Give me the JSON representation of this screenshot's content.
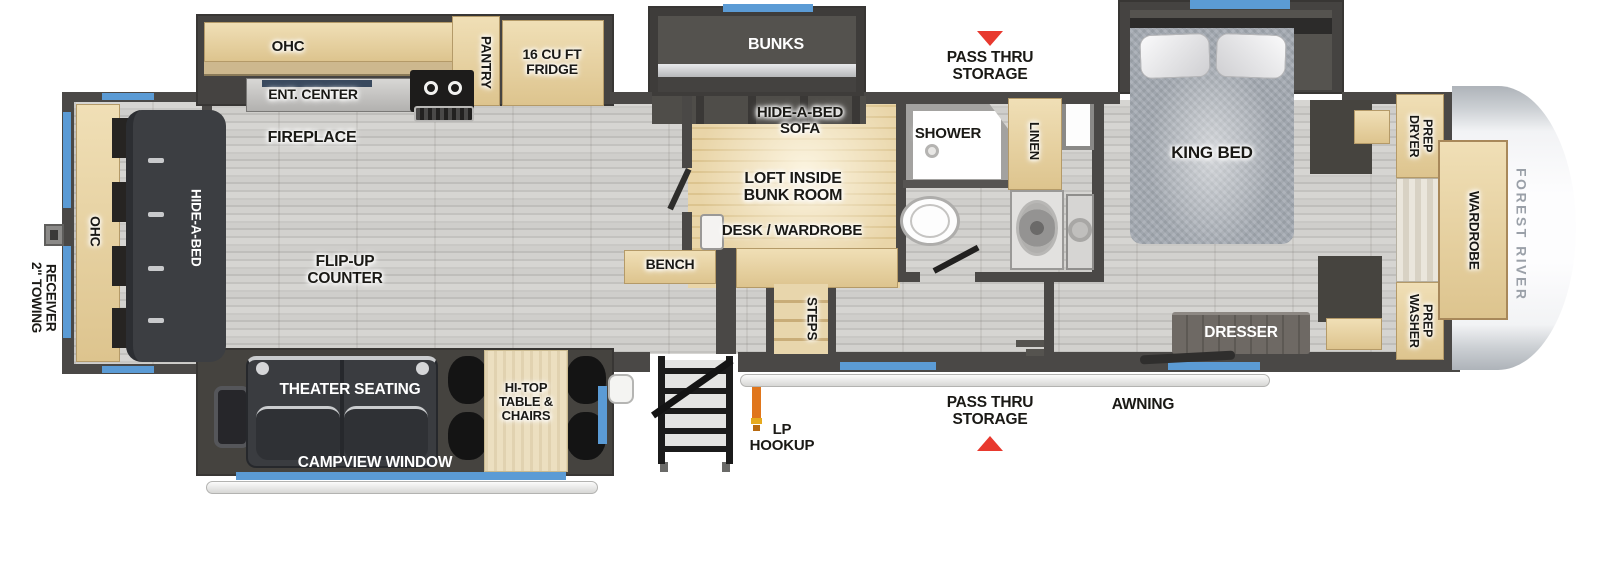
{
  "title": "Fifth Wheel RV Floorplan",
  "brand": "FOREST RIVER",
  "colors": {
    "wall": "#4a4846",
    "cabinet_wood": "#e7d3a6",
    "window_blue": "#5b9bd5",
    "arrow_red": "#e8392e",
    "floor": "#cdccc9"
  },
  "labels": {
    "towing_receiver": "2\" TOWING\nRECEIVER",
    "rear_ohc": "OHC",
    "rear_hide_a_bed": "HIDE-A-BED",
    "fireplace": "FIREPLACE",
    "flip_up_counter": "FLIP-UP\nCOUNTER",
    "kitchen_ohc": "OHC",
    "ent_center": "ENT. CENTER",
    "pantry": "PANTRY",
    "fridge": "16 CU FT\nFRIDGE",
    "bunks": "BUNKS",
    "hide_a_bed_sofa": "HIDE-A-BED\nSOFA",
    "loft_inside_bunk_room": "LOFT INSIDE\nBUNK ROOM",
    "desk_wardrobe": "DESK / WARDROBE",
    "bench": "BENCH",
    "steps": "STEPS",
    "shower": "SHOWER",
    "linen": "LINEN",
    "pass_thru_storage_top": "PASS THRU\nSTORAGE",
    "pass_thru_storage_bottom": "PASS THRU\nSTORAGE",
    "king_bed": "KING BED",
    "dryer_prep": "DRYER\nPREP",
    "washer_prep": "WASHER\nPREP",
    "wardrobe": "WARDROBE",
    "dresser": "DRESSER",
    "theater_seating": "THEATER SEATING",
    "hi_top_table": "HI-TOP\nTABLE &\nCHAIRS",
    "campview_window": "CAMPVIEW WINDOW",
    "lp_hookup": "LP\nHOOKUP",
    "awning": "AWNING"
  }
}
